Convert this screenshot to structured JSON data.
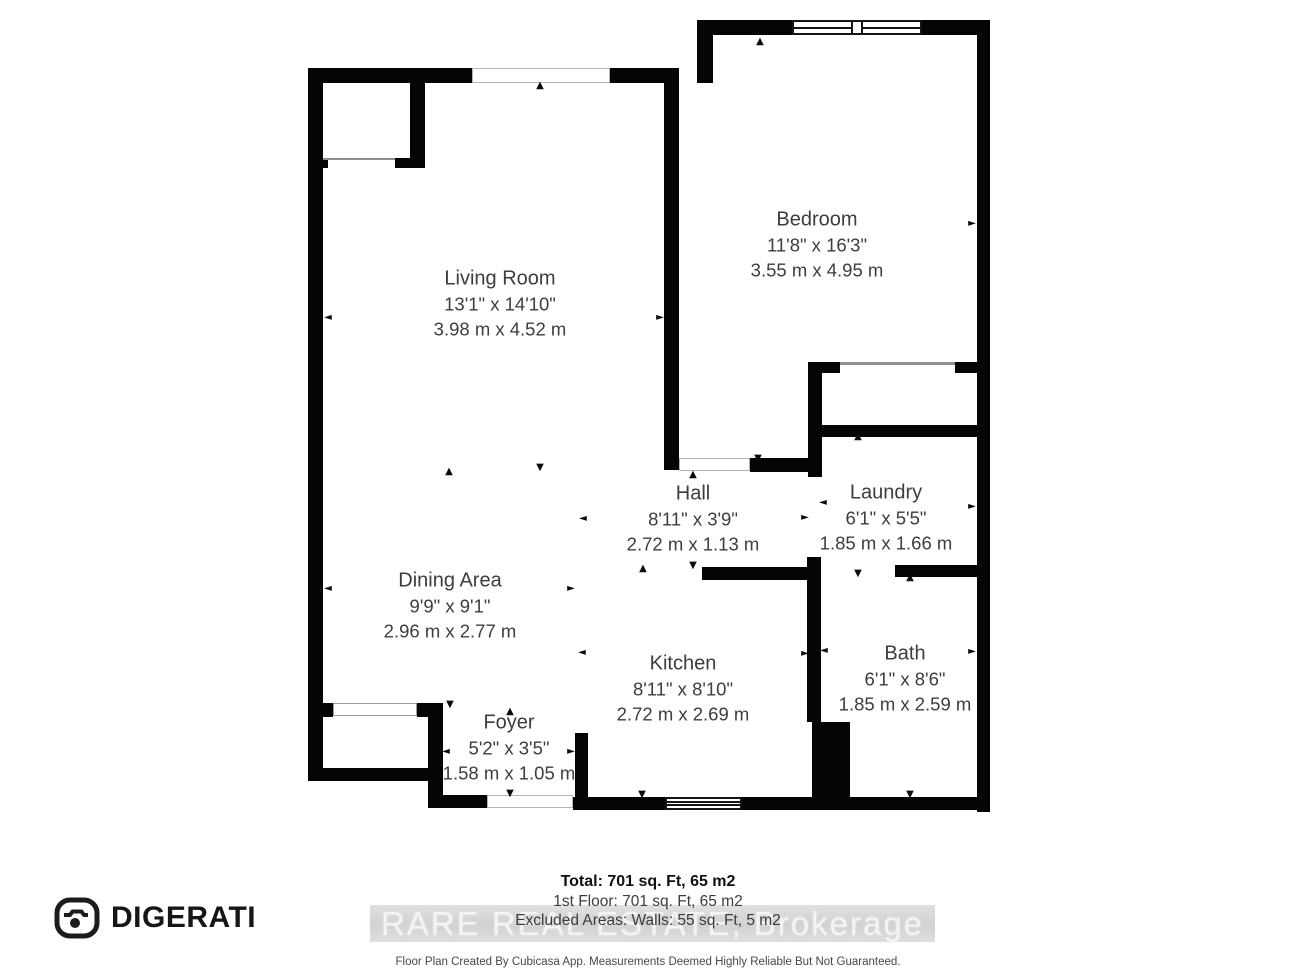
{
  "floorplan": {
    "background": "#ffffff",
    "wall_color": "#050505",
    "label_color": "#3d3d3d",
    "rooms": [
      {
        "id": "living-room",
        "name": "Living Room",
        "imperial": "13'1\" x 14'10\"",
        "metric": "3.98 m x 4.52 m",
        "cx": 500,
        "cy": 304
      },
      {
        "id": "bedroom",
        "name": "Bedroom",
        "imperial": "11'8\" x 16'3\"",
        "metric": "3.55 m x 4.95 m",
        "cx": 817,
        "cy": 245
      },
      {
        "id": "hall",
        "name": "Hall",
        "imperial": "8'11\" x 3'9\"",
        "metric": "2.72 m x 1.13 m",
        "cx": 693,
        "cy": 519
      },
      {
        "id": "laundry",
        "name": "Laundry",
        "imperial": "6'1\" x 5'5\"",
        "metric": "1.85 m x 1.66 m",
        "cx": 886,
        "cy": 518
      },
      {
        "id": "dining-area",
        "name": "Dining Area",
        "imperial": "9'9\" x 9'1\"",
        "metric": "2.96 m x 2.77 m",
        "cx": 450,
        "cy": 606
      },
      {
        "id": "kitchen",
        "name": "Kitchen",
        "imperial": "8'11\" x 8'10\"",
        "metric": "2.72 m x 2.69 m",
        "cx": 683,
        "cy": 689
      },
      {
        "id": "bath",
        "name": "Bath",
        "imperial": "6'1\" x 8'6\"",
        "metric": "1.85 m x 2.59 m",
        "cx": 905,
        "cy": 679
      },
      {
        "id": "foyer",
        "name": "Foyer",
        "imperial": "5'2\" x 3'5\"",
        "metric": "1.58 m x 1.05 m",
        "cx": 509,
        "cy": 748
      }
    ],
    "walls": [
      [
        697,
        20,
        95,
        15
      ],
      [
        922,
        20,
        68,
        15
      ],
      [
        977,
        20,
        13,
        792
      ],
      [
        308,
        68,
        164,
        15
      ],
      [
        610,
        68,
        69,
        15
      ],
      [
        697,
        20,
        16,
        63
      ],
      [
        308,
        68,
        15,
        712
      ],
      [
        664,
        83,
        15,
        387
      ],
      [
        410,
        83,
        15,
        85
      ],
      [
        395,
        158,
        30,
        10
      ],
      [
        308,
        158,
        20,
        10
      ],
      [
        750,
        458,
        60,
        14
      ],
      [
        808,
        362,
        14,
        115
      ],
      [
        822,
        362,
        18,
        11
      ],
      [
        955,
        362,
        22,
        11
      ],
      [
        808,
        425,
        169,
        12
      ],
      [
        807,
        557,
        14,
        165
      ],
      [
        812,
        722,
        38,
        86
      ],
      [
        702,
        567,
        106,
        13
      ],
      [
        895,
        565,
        82,
        12
      ],
      [
        573,
        797,
        92,
        13
      ],
      [
        742,
        797,
        248,
        13
      ],
      [
        575,
        733,
        13,
        77
      ],
      [
        428,
        795,
        59,
        13
      ],
      [
        428,
        703,
        15,
        105
      ],
      [
        417,
        703,
        13,
        14
      ],
      [
        323,
        703,
        10,
        14
      ],
      [
        308,
        768,
        135,
        13
      ]
    ],
    "openings": [
      {
        "t": "window",
        "name": "bedroom-window",
        "x": 792,
        "y": 20,
        "w": 130,
        "h": 15
      },
      {
        "t": "frame",
        "name": "living-room-opening",
        "x": 472,
        "y": 68,
        "w": 138,
        "h": 15
      },
      {
        "t": "line",
        "name": "bedroom-closet-slider",
        "x": 840,
        "y": 362,
        "w": 115,
        "h": 3
      },
      {
        "t": "frame",
        "name": "bedroom-door-opening",
        "x": 679,
        "y": 458,
        "w": 71,
        "h": 13
      },
      {
        "t": "window3",
        "name": "kitchen-window",
        "x": 665,
        "y": 797,
        "w": 77,
        "h": 13
      },
      {
        "t": "frame",
        "name": "entry-door-opening",
        "x": 487,
        "y": 795,
        "w": 86,
        "h": 13
      },
      {
        "t": "closet",
        "name": "foyer-closet-door",
        "x": 333,
        "y": 703,
        "w": 84,
        "h": 13
      },
      {
        "t": "line",
        "name": "living-closet-line",
        "x": 323,
        "y": 158,
        "w": 72,
        "h": 2
      }
    ],
    "arrows": [
      {
        "d": "up",
        "x": 760,
        "y": 42
      },
      {
        "d": "up",
        "x": 540,
        "y": 86
      },
      {
        "d": "right",
        "x": 972,
        "y": 224
      },
      {
        "d": "left",
        "x": 328,
        "y": 318
      },
      {
        "d": "right",
        "x": 660,
        "y": 318
      },
      {
        "d": "up",
        "x": 449,
        "y": 472
      },
      {
        "d": "down",
        "x": 540,
        "y": 468
      },
      {
        "d": "down",
        "x": 758,
        "y": 459
      },
      {
        "d": "up",
        "x": 858,
        "y": 437
      },
      {
        "d": "up",
        "x": 693,
        "y": 475
      },
      {
        "d": "left",
        "x": 583,
        "y": 519
      },
      {
        "d": "right",
        "x": 805,
        "y": 518
      },
      {
        "d": "left",
        "x": 823,
        "y": 503
      },
      {
        "d": "right",
        "x": 972,
        "y": 507
      },
      {
        "d": "up",
        "x": 643,
        "y": 569
      },
      {
        "d": "down",
        "x": 693,
        "y": 566
      },
      {
        "d": "down",
        "x": 858,
        "y": 574
      },
      {
        "d": "up",
        "x": 910,
        "y": 578
      },
      {
        "d": "left",
        "x": 328,
        "y": 589
      },
      {
        "d": "right",
        "x": 571,
        "y": 589
      },
      {
        "d": "left",
        "x": 582,
        "y": 653
      },
      {
        "d": "right",
        "x": 805,
        "y": 654
      },
      {
        "d": "left",
        "x": 824,
        "y": 651
      },
      {
        "d": "right",
        "x": 972,
        "y": 652
      },
      {
        "d": "down",
        "x": 450,
        "y": 705
      },
      {
        "d": "up",
        "x": 510,
        "y": 712
      },
      {
        "d": "left",
        "x": 446,
        "y": 752
      },
      {
        "d": "right",
        "x": 571,
        "y": 752
      },
      {
        "d": "down",
        "x": 510,
        "y": 794
      },
      {
        "d": "down",
        "x": 642,
        "y": 795
      },
      {
        "d": "down",
        "x": 910,
        "y": 795
      }
    ]
  },
  "footer": {
    "brand": "DIGERATI",
    "total": "Total: 701 sq. Ft, 65 m2",
    "first_floor": "1st Floor: 701 sq. Ft, 65 m2",
    "excluded": "Excluded Areas: Walls: 55 sq. Ft, 5 m2",
    "watermark": "RARE REAL ESTATE, Brokerage",
    "disclaimer": "Floor Plan Created By Cubicasa App. Measurements Deemed Highly Reliable But Not Guaranteed."
  }
}
